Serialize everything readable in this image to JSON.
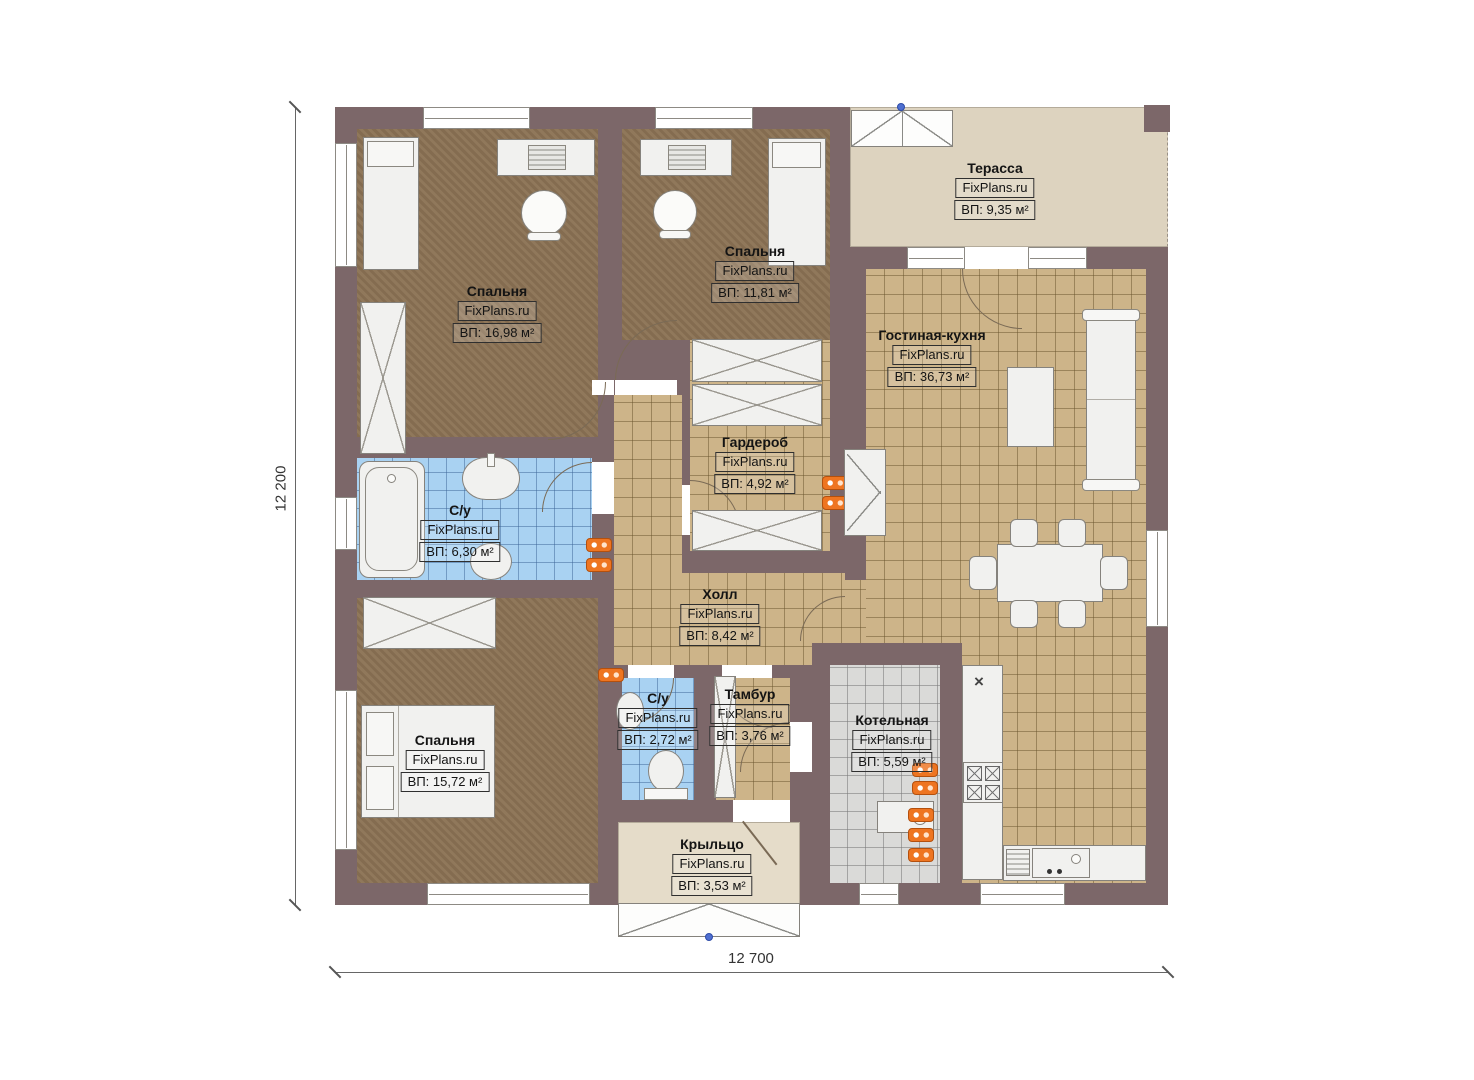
{
  "watermark": "FixPlans.ru",
  "dims": {
    "height_label": "12 200",
    "width_label": "12 700"
  },
  "symbols": {
    "vent": "×"
  },
  "colors": {
    "wall": "#7c6769",
    "bedroom_floor": "#8b7254",
    "tile_floor": "#cdb489",
    "bath_floor": "#a9d2f2",
    "boiler_floor": "#dadad8",
    "terrace_floor": "#ddd3bf",
    "radiator": "#ee7521"
  },
  "rooms": [
    {
      "id": "bedroom-1",
      "name": "Спальня",
      "brand": "FixPlans.ru",
      "area": "ВП: 16,98 м²"
    },
    {
      "id": "bedroom-2",
      "name": "Спальня",
      "brand": "FixPlans.ru",
      "area": "ВП: 11,81 м²"
    },
    {
      "id": "terrace",
      "name": "Терасса",
      "brand": "FixPlans.ru",
      "area": "ВП: 9,35 м²"
    },
    {
      "id": "living-kitchen",
      "name": "Гостиная-кухня",
      "brand": "FixPlans.ru",
      "area": "ВП: 36,73 м²"
    },
    {
      "id": "wardrobe-room",
      "name": "Гардероб",
      "brand": "FixPlans.ru",
      "area": "ВП: 4,92 м²"
    },
    {
      "id": "bathroom-1",
      "name": "С/у",
      "brand": "FixPlans.ru",
      "area": "ВП: 6,30 м²"
    },
    {
      "id": "hall",
      "name": "Холл",
      "brand": "FixPlans.ru",
      "area": "ВП: 8,42 м²"
    },
    {
      "id": "bedroom-3",
      "name": "Спальня",
      "brand": "FixPlans.ru",
      "area": "ВП: 15,72 м²"
    },
    {
      "id": "bathroom-2",
      "name": "С/у",
      "brand": "FixPlans.ru",
      "area": "ВП: 2,72 м²"
    },
    {
      "id": "vestibule",
      "name": "Тамбур",
      "brand": "FixPlans.ru",
      "area": "ВП: 3,76 м²"
    },
    {
      "id": "boiler-room",
      "name": "Котельная",
      "brand": "FixPlans.ru",
      "area": "ВП: 5,59 м²"
    },
    {
      "id": "porch",
      "name": "Крыльцо",
      "brand": "FixPlans.ru",
      "area": "ВП: 3,53 м²"
    }
  ]
}
